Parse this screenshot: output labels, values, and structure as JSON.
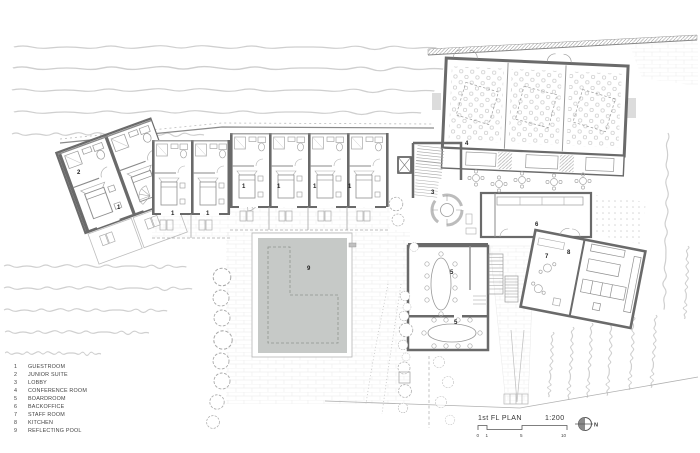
{
  "legend": {
    "items": [
      {
        "num": "1",
        "label": "GUESTROOM"
      },
      {
        "num": "2",
        "label": "JUNIOR SUITE"
      },
      {
        "num": "3",
        "label": "LOBBY"
      },
      {
        "num": "4",
        "label": "CONFERENCE ROOM"
      },
      {
        "num": "5",
        "label": "BOARDROOM"
      },
      {
        "num": "6",
        "label": "BACKOFFICE"
      },
      {
        "num": "7",
        "label": "STAFF ROOM"
      },
      {
        "num": "8",
        "label": "KITCHEN"
      },
      {
        "num": "9",
        "label": "REFLECTING POOL"
      }
    ]
  },
  "plan": {
    "labels": [
      "2",
      "1",
      "1",
      "1",
      "1",
      "1",
      "1",
      "1",
      "3",
      "4",
      "5",
      "5",
      "6",
      "7",
      "8",
      "9"
    ]
  },
  "titleblock": {
    "title": "1st FL PLAN",
    "scale": "1:200",
    "ticks": [
      "0",
      "1",
      "5",
      "10"
    ],
    "north": "N"
  },
  "colors": {
    "wall": "#6a6a6a",
    "pool": "#c6c9c7",
    "landscape": "#cacaca",
    "paving": "#e2e2e2"
  }
}
